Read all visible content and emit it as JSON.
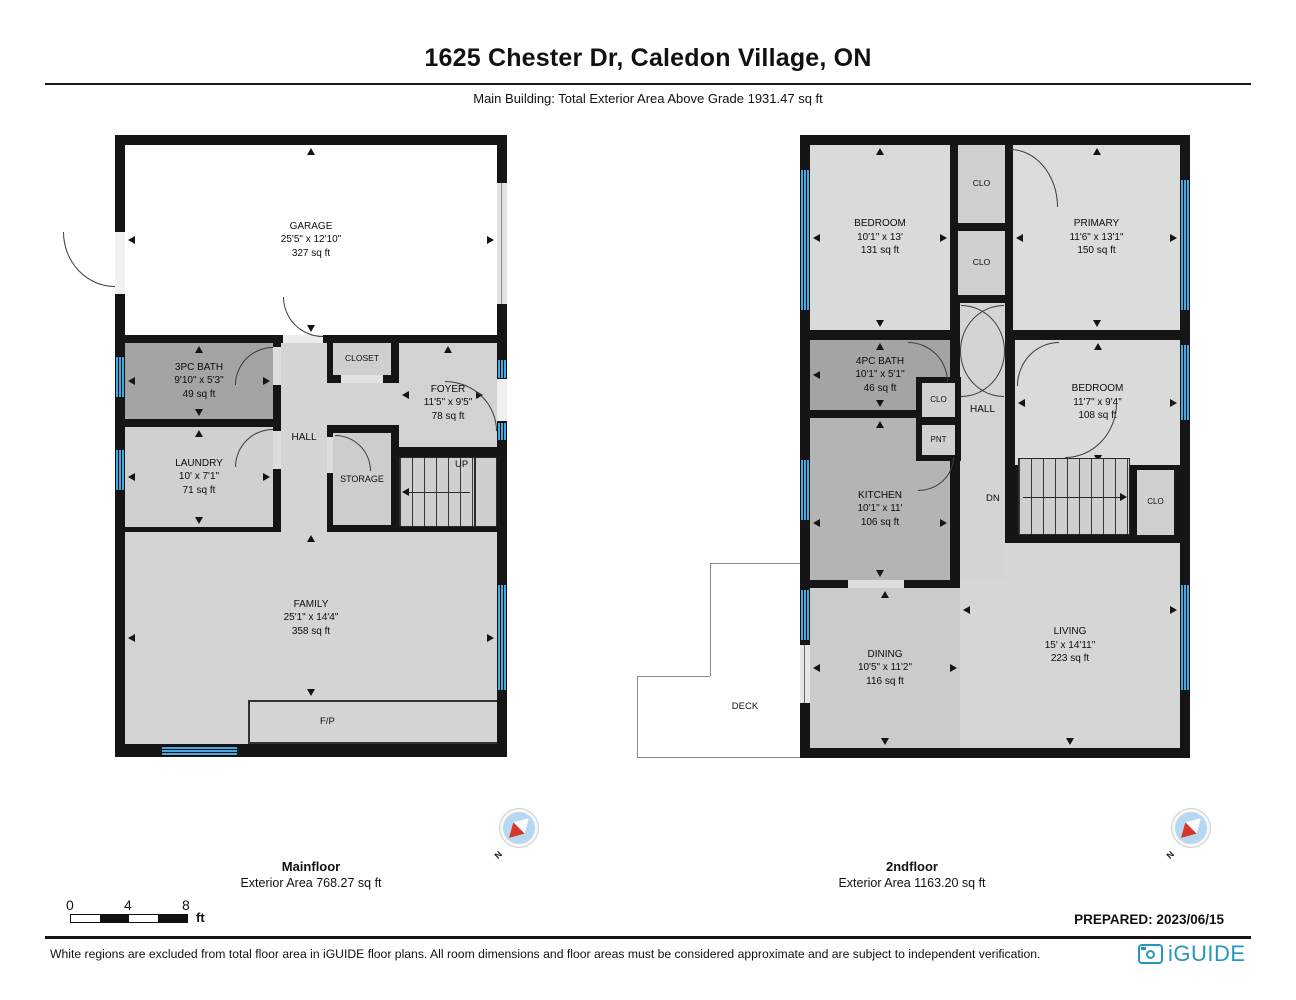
{
  "header": {
    "title": "1625 Chester Dr, Caledon Village, ON",
    "subtitle": "Main Building: Total Exterior Area Above Grade 1931.47 sq ft"
  },
  "mf": {
    "floor_label": "Mainfloor",
    "floor_area": "Exterior Area 768.27 sq ft",
    "rooms": {
      "garage": {
        "name": "GARAGE",
        "dims": "25'5\" x 12'10\"",
        "area": "327 sq ft"
      },
      "bath": {
        "name": "3PC BATH",
        "dims": "9'10\" x 5'3\"",
        "area": "49 sq ft"
      },
      "laundry": {
        "name": "LAUNDRY",
        "dims": "10' x 7'1\"",
        "area": "71 sq ft"
      },
      "hall": {
        "name": "HALL"
      },
      "closet": {
        "name": "CLOSET"
      },
      "foyer": {
        "name": "FOYER",
        "dims": "11'5\" x 9'5\"",
        "area": "78 sq ft"
      },
      "storage": {
        "name": "STORAGE"
      },
      "family": {
        "name": "FAMILY",
        "dims": "25'1\" x 14'4\"",
        "area": "358 sq ft"
      },
      "fp": {
        "name": "F/P"
      },
      "up": {
        "name": "UP"
      }
    }
  },
  "sf": {
    "floor_label": "2ndfloor",
    "floor_area": "Exterior Area 1163.20 sq ft",
    "rooms": {
      "bedroom1": {
        "name": "BEDROOM",
        "dims": "10'1\" x 13'",
        "area": "131 sq ft"
      },
      "clo": {
        "name": "CLO"
      },
      "primary": {
        "name": "PRIMARY",
        "dims": "11'6\" x 13'1\"",
        "area": "150 sq ft"
      },
      "bath": {
        "name": "4PC BATH",
        "dims": "10'1\" x 5'1\"",
        "area": "46 sq ft"
      },
      "pnt": {
        "name": "PNT"
      },
      "hall": {
        "name": "HALL"
      },
      "bedroom2": {
        "name": "BEDROOM",
        "dims": "11'7\" x 9'4\"",
        "area": "108 sq ft"
      },
      "kitchen": {
        "name": "KITCHEN",
        "dims": "10'1\" x 11'",
        "area": "106 sq ft"
      },
      "dn": {
        "name": "DN"
      },
      "dining": {
        "name": "DINING",
        "dims": "10'5\" x 11'2\"",
        "area": "116 sq ft"
      },
      "living": {
        "name": "LIVING",
        "dims": "15' x 14'11\"",
        "area": "223 sq ft"
      },
      "deck": {
        "name": "DECK"
      }
    }
  },
  "scalebar": {
    "tick0": "0",
    "tick1": "4",
    "tick2": "8",
    "unit": "ft"
  },
  "compass": {
    "north_label": "N"
  },
  "footer": {
    "prepared": "PREPARED: 2023/06/15",
    "disclaimer": "White regions are excluded from total floor area in iGUIDE floor plans. All room dimensions and floor areas must be considered approximate and are subject to independent verification.",
    "brand": "iGUIDE"
  },
  "colors": {
    "window_blue": "#46a9e1",
    "brand_blue": "#2596be",
    "compass_red": "#d5352b"
  }
}
